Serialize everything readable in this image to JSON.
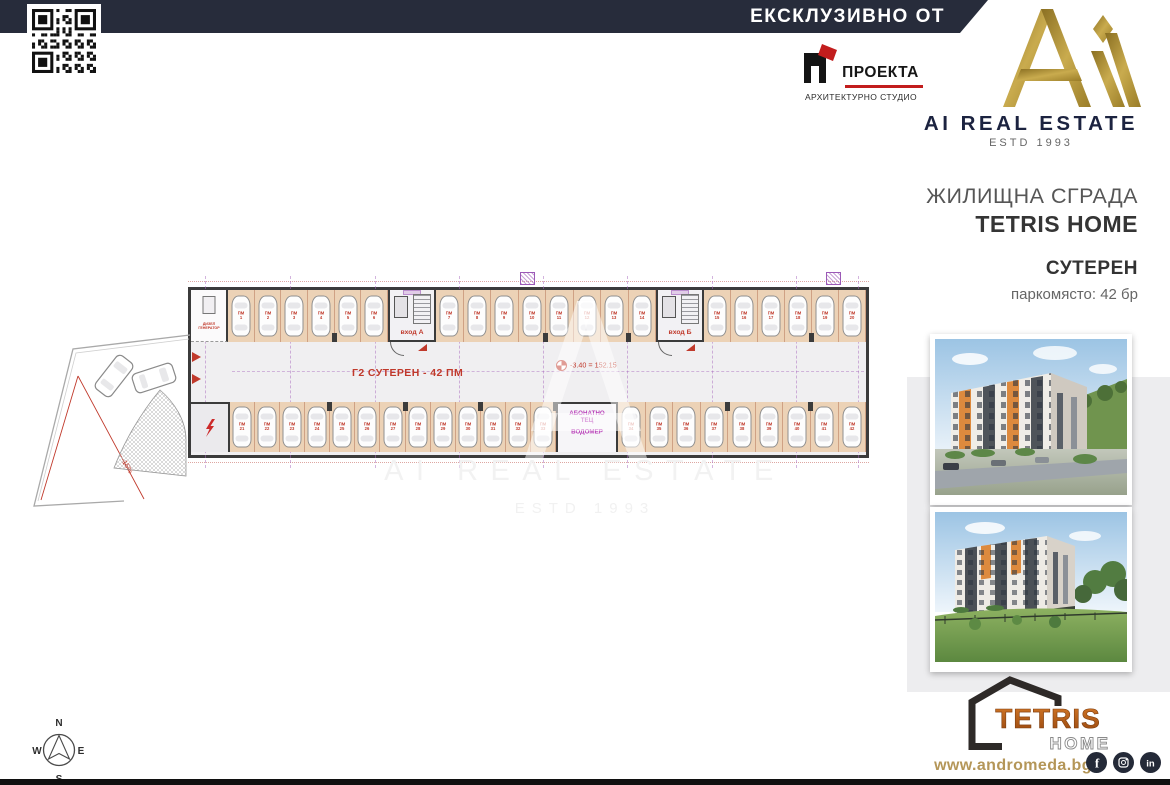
{
  "banner": {
    "text": "ЕКСКЛУЗИВНО ОТ"
  },
  "architect": {
    "name": "ПРОЕКТА",
    "subtitle": "АРХИТЕКТУРНО СТУДИО"
  },
  "brand": {
    "name": "AI REAL ESTATE",
    "estd": "ESTD 1993"
  },
  "project": {
    "building_type": "ЖИЛИЩНА СГРАДА",
    "name": "TETRIS HOME",
    "level": "СУТЕРЕН",
    "parking_summary": "паркомясто: 42 бр"
  },
  "plan": {
    "aisle_label": "Г2  СУТЕРЕН - 42 ПМ",
    "entrance_a": "вход А",
    "entrance_b": "вход Б",
    "tec_room": [
      "АБОНАТНО",
      "ТЕЦ",
      "ВОДОМЕР"
    ],
    "generator_room": [
      "ДИЗЕЛ",
      "ГЕНЕРАТОР"
    ],
    "elevation_mark": "-3.40 = 152.15",
    "ramp_slope": "15%",
    "stall_prefix": "ПМ",
    "stall_count_total": 42,
    "top_segments": [
      6,
      8,
      6
    ],
    "bottom_segments": [
      13,
      9
    ]
  },
  "watermark": {
    "line1": "AI REAL ESTATE",
    "line2": "ESTD 1993"
  },
  "compass": {
    "n": "N",
    "e": "E",
    "s": "S",
    "w": "W"
  },
  "footer": {
    "logo_word": "TETRIS",
    "logo_home": "HOME",
    "website": "www.andromeda.bg",
    "social": [
      "facebook",
      "instagram",
      "linkedin"
    ]
  },
  "colors": {
    "navy": "#272c3b",
    "gold": "#ab8c33",
    "red": "#c0392b",
    "magenta": "#b83db8",
    "tan": "#ecd2b6",
    "panel_gray": "#ededef",
    "orange": "#dd8a3e",
    "gold_text": "#b49658"
  }
}
